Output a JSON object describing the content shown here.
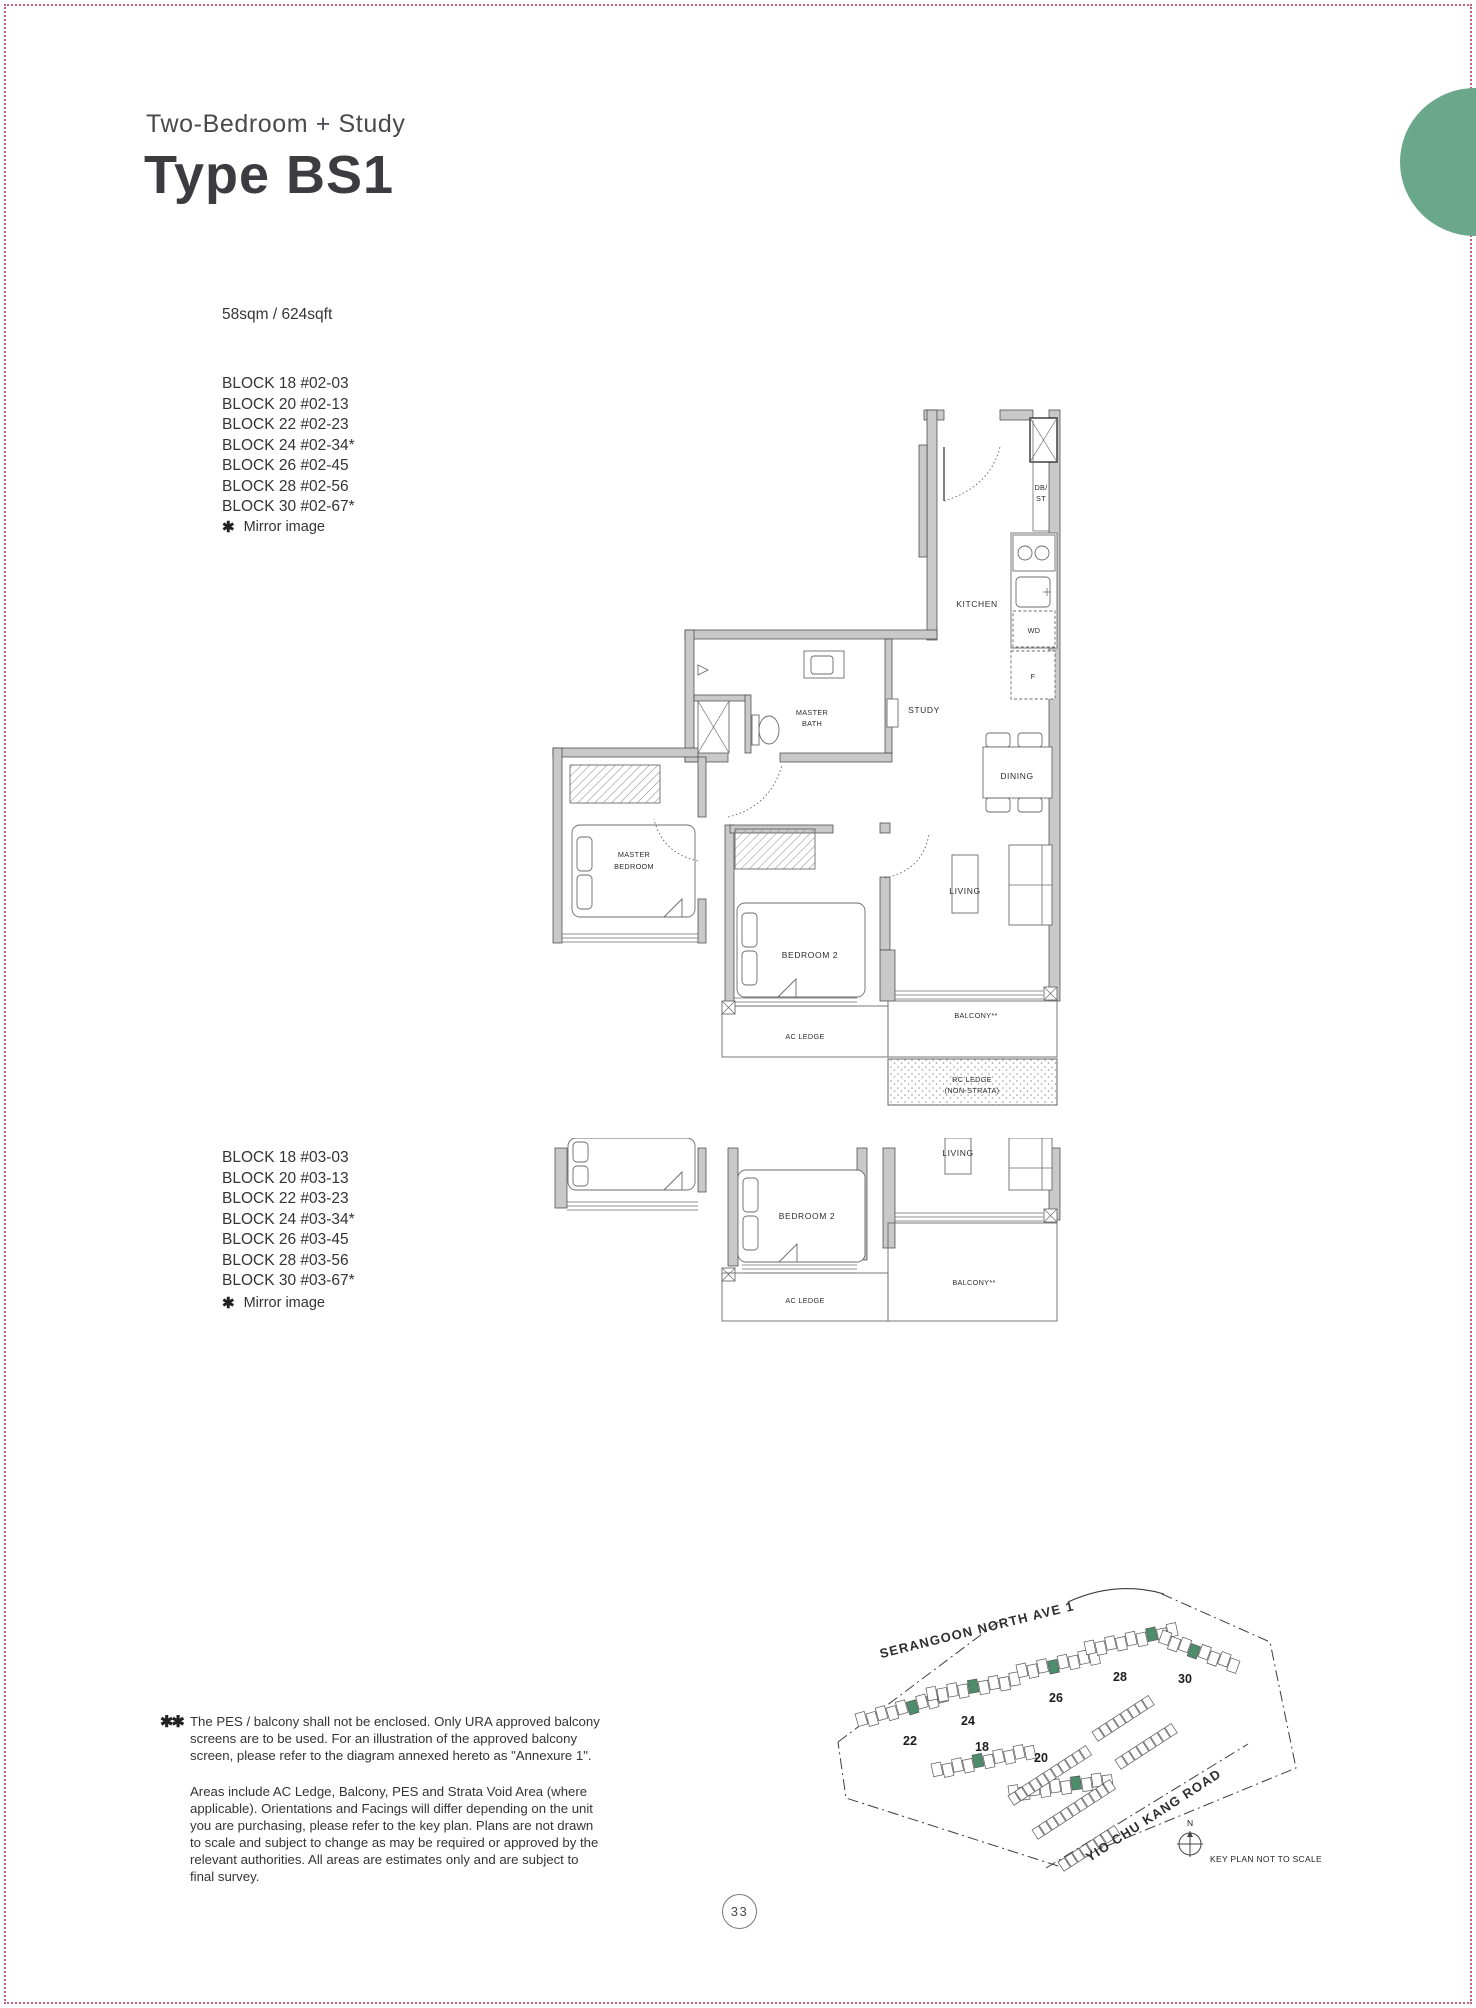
{
  "page": {
    "number": "33",
    "border_color": "#c4607b",
    "accent_color": "#6ba78a"
  },
  "header": {
    "subtitle": "Two-Bedroom + Study",
    "title": "Type BS1"
  },
  "unit": {
    "area": "58sqm / 624sqft",
    "stacks_level2": [
      "BLOCK 18 #02-03",
      "BLOCK 20 #02-13",
      "BLOCK 22 #02-23",
      "BLOCK 24 #02-34*",
      "BLOCK 26 #02-45",
      "BLOCK 28 #02-56",
      "BLOCK 30 #02-67*"
    ],
    "stacks_level3": [
      "BLOCK 18 #03-03",
      "BLOCK 20 #03-13",
      "BLOCK 22 #03-23",
      "BLOCK 24 #03-34*",
      "BLOCK 26 #03-45",
      "BLOCK 28 #03-56",
      "BLOCK 30 #03-67*"
    ],
    "mirror_marker": "✱",
    "mirror_note": "Mirror image"
  },
  "floor_plan": {
    "labels": {
      "kitchen": "KITCHEN",
      "db_line1": "DB/",
      "db_line2": "ST",
      "wd": "WD",
      "fridge": "F",
      "study": "STUDY",
      "dining": "DINING",
      "living": "LIVING",
      "master_bath_line1": "MASTER",
      "master_bath_line2": "BATH",
      "master_bedroom_line1": "MASTER",
      "master_bedroom_line2": "BEDROOM",
      "bedroom2": "BEDROOM 2",
      "ac_ledge": "AC LEDGE",
      "balcony": "BALCONY**",
      "rc_ledge_line1": "RC LEDGE",
      "rc_ledge_line2": "(NON-STRATA)"
    }
  },
  "key_plan": {
    "road_top": "SERANGOON NORTH AVE 1",
    "road_bottom": "YIO CHU KANG ROAD",
    "note": "KEY PLAN NOT TO SCALE",
    "compass_label": "N",
    "highlight_color": "#4e8d6c",
    "clusters": [
      {
        "label": "22",
        "x": 37,
        "y": 142,
        "rot": -16,
        "count": 9,
        "green": 5,
        "lx": 92,
        "ly": 173
      },
      {
        "label": "24",
        "x": 108,
        "y": 116,
        "rot": -10,
        "count": 9,
        "green": 4,
        "lx": 150,
        "ly": 153
      },
      {
        "label": "26",
        "x": 198,
        "y": 93,
        "rot": -12,
        "count": 8,
        "green": 3,
        "lx": 238,
        "ly": 130
      },
      {
        "label": "28",
        "x": 266,
        "y": 70,
        "rot": -12,
        "count": 9,
        "green": 6,
        "lx": 302,
        "ly": 109
      },
      {
        "label": "30",
        "x": 345,
        "y": 58,
        "rot": 20,
        "count": 8,
        "green": 3,
        "lx": 367,
        "ly": 111
      },
      {
        "label": "18",
        "x": 113,
        "y": 192,
        "rot": -12,
        "count": 10,
        "green": 4,
        "lx": 164,
        "ly": 179
      },
      {
        "label": "20",
        "x": 190,
        "y": 214,
        "rot": -8,
        "count": 10,
        "green": 6,
        "lx": 223,
        "ly": 190
      }
    ],
    "strips": [
      {
        "x": 190,
        "y": 224,
        "rot": -33,
        "count": 11
      },
      {
        "x": 214,
        "y": 258,
        "rot": -33,
        "count": 11
      },
      {
        "x": 240,
        "y": 290,
        "rot": -33,
        "count": 8
      },
      {
        "x": 274,
        "y": 160,
        "rot": -33,
        "count": 8
      },
      {
        "x": 297,
        "y": 188,
        "rot": -33,
        "count": 8
      }
    ]
  },
  "footnotes": {
    "marker": "✱✱",
    "note1": "The PES / balcony shall not be enclosed. Only URA approved balcony screens are to be used. For an illustration of the approved balcony screen, please refer to the diagram annexed hereto as \"Annexure 1\".",
    "note2": "Areas include AC Ledge, Balcony, PES and Strata Void Area (where applicable). Orientations and Facings will differ depending on the unit you are purchasing, please refer to the key plan. Plans are not drawn to scale and subject to change as may be required or approved by the relevant authorities. All areas are estimates only and are subject to final survey."
  }
}
